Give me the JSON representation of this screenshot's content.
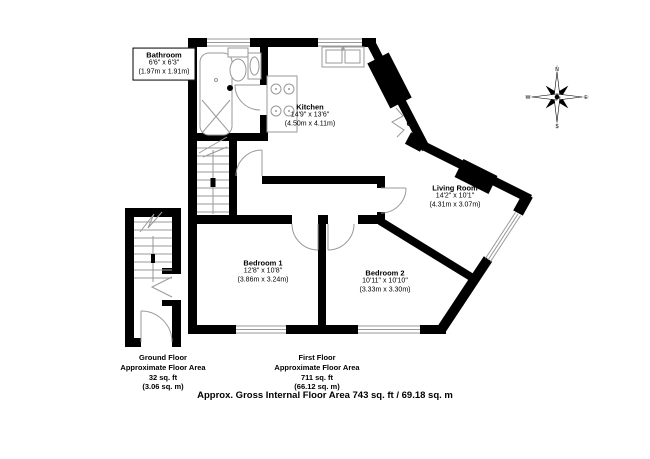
{
  "plan": {
    "rooms": {
      "bathroom": {
        "name": "Bathroom",
        "imperial": "6'6\" x 6'3\"",
        "metric": "(1.97m x 1.91m)"
      },
      "kitchen": {
        "name": "Kitchen",
        "imperial": "14'9\" x 13'6\"",
        "metric": "(4.50m x 4.11m)"
      },
      "living": {
        "name": "Living Room",
        "imperial": "14'2\" x 10'1\"",
        "metric": "(4.31m x 3.07m)"
      },
      "bedroom1": {
        "name": "Bedroom 1",
        "imperial": "12'8\" x 10'8\"",
        "metric": "(3.86m x 3.24m)"
      },
      "bedroom2": {
        "name": "Bedroom 2",
        "imperial": "10'11\" x 10'10\"",
        "metric": "(3.33m x 3.30m)"
      }
    },
    "cupboard_label": "C",
    "compass": {
      "n": "N",
      "e": "E",
      "s": "S",
      "w": "W"
    },
    "footers": {
      "ground": {
        "title": "Ground Floor",
        "line1": "Approximate Floor Area",
        "line2": "32 sq. ft",
        "line3": "(3.06 sq. m)"
      },
      "first": {
        "title": "First Floor",
        "line1": "Approximate Floor Area",
        "line2": "711 sq. ft",
        "line3": "(66.12 sq. m)"
      },
      "gross": "Approx. Gross Internal Floor Area 743 sq. ft / 69.18 sq. m"
    },
    "colors": {
      "wall": "#000000",
      "line": "#999999",
      "background": "#ffffff"
    }
  }
}
